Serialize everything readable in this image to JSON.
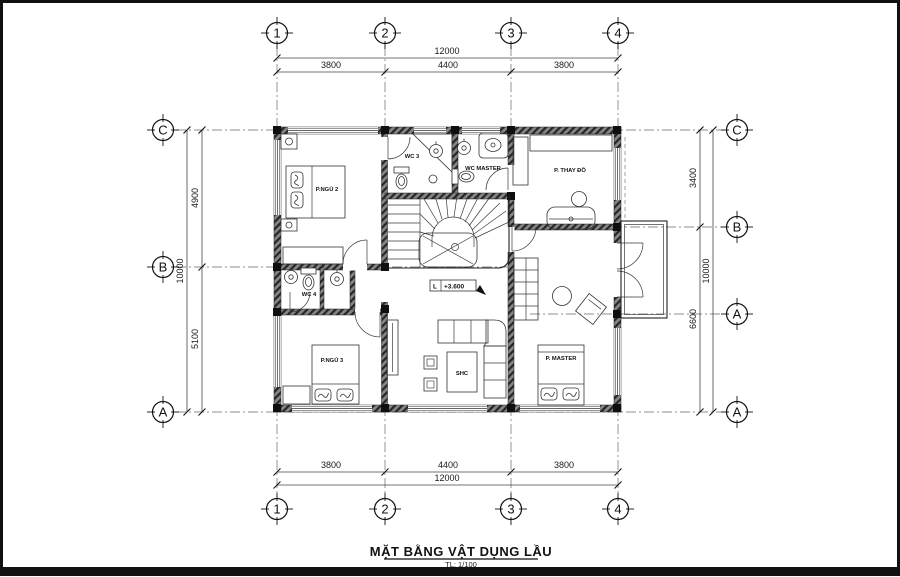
{
  "title_block": {
    "title": "MẶT BẰNG VẬT DỤNG LẦU",
    "scale": "TL: 1/100"
  },
  "grid": {
    "cols": [
      "1",
      "2",
      "3",
      "4"
    ],
    "rows_left": [
      "C",
      "B",
      "A"
    ],
    "rows_right": [
      "C",
      "B",
      "A",
      "A"
    ]
  },
  "dimensions": {
    "horizontal": {
      "total": "12000",
      "segments": [
        "3800",
        "4400",
        "3800"
      ]
    },
    "left": {
      "total": "10000",
      "segments": [
        "4900",
        "5100"
      ]
    },
    "right": {
      "total": "10000",
      "segments": [
        "3400",
        "6600"
      ]
    }
  },
  "rooms": {
    "bedroom2": "P.NGỦ 2",
    "wc3": "WC 3",
    "wc_master": "WC MASTER",
    "dressing_room": "P. THAY ĐỒ",
    "wc4": "WC 4",
    "bedroom3": "P.NGỦ 3",
    "living_table": "SHC",
    "master_bedroom": "P. MASTER"
  },
  "level_marker": {
    "prefix": "L",
    "value": "+3.600"
  },
  "colors": {
    "line": "#222222",
    "wall": "#2a2a2a",
    "paper": "#ffffff"
  }
}
